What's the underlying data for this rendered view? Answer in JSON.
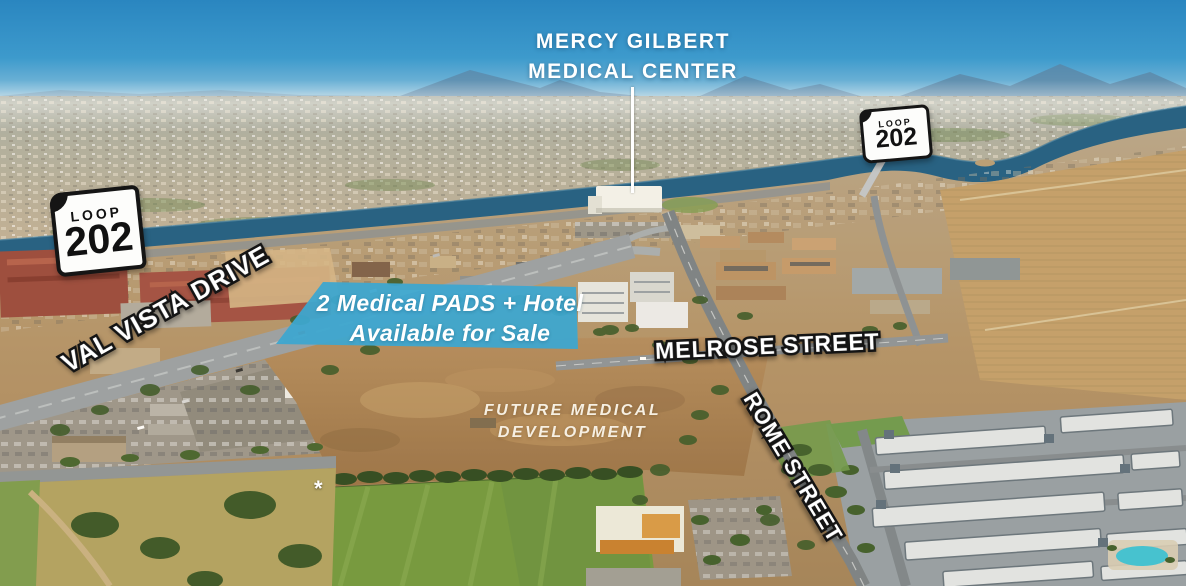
{
  "annotations": {
    "medical_center": {
      "line1": "MERCY GILBERT",
      "line2": "MEDICAL CENTER"
    },
    "route_shields": [
      {
        "name": "loop-202-shield-left",
        "top": "LOOP",
        "number": "202"
      },
      {
        "name": "loop-202-shield-right",
        "top": "LOOP",
        "number": "202"
      }
    ],
    "streets": {
      "val_vista": "VAL VISTA DRIVE",
      "melrose": "MELROSE STREET",
      "rome": "ROME STREET"
    },
    "sale_parcel": {
      "line1": "2 Medical PADS + Hotel",
      "line2": "Available for Sale",
      "fill_color": "#35a6d6"
    },
    "future_development": {
      "line1": "FUTURE MEDICAL",
      "line2": "DEVELOPMENT"
    },
    "footnote_marker": "*"
  },
  "colors": {
    "sky": "#2e8fc5",
    "river": "#1f5e85",
    "dirt_lot": "#a8805a",
    "field_green": "#72993f",
    "townhome_gray": "#96a0a7",
    "label_text": "#ffffff",
    "label_outline": "#141414"
  }
}
